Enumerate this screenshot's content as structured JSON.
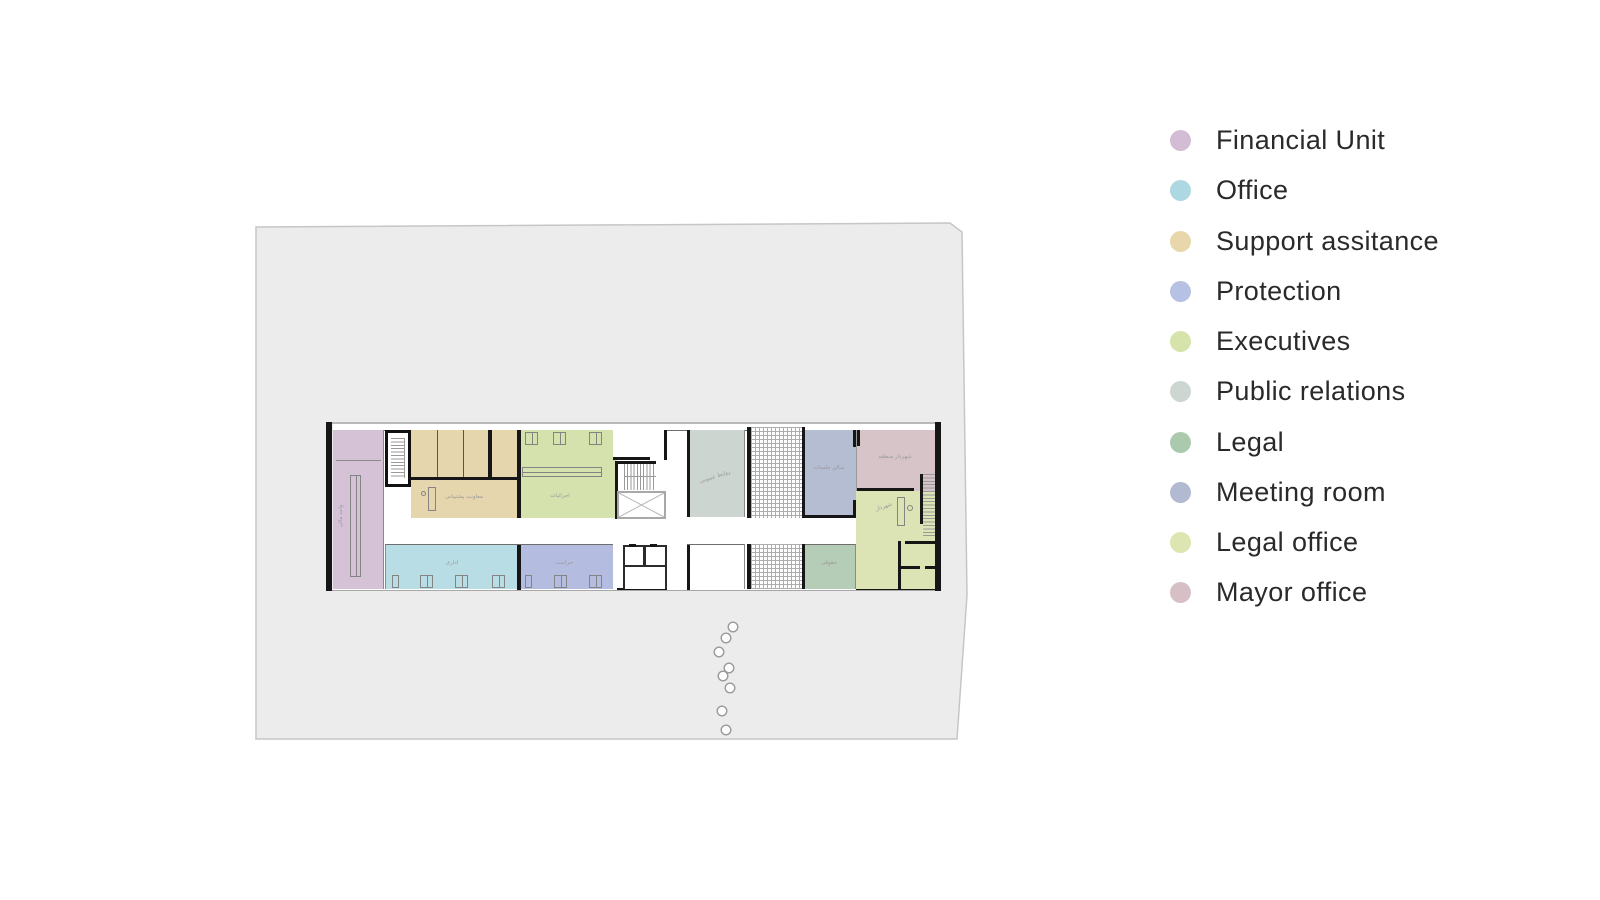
{
  "legend": {
    "items": [
      {
        "label": "Financial Unit",
        "color": "#d3bdd5"
      },
      {
        "label": "Office",
        "color": "#aed8e1"
      },
      {
        "label": "Support assitance",
        "color": "#e7d7ab"
      },
      {
        "label": "Protection",
        "color": "#b7c1e4"
      },
      {
        "label": "Executives",
        "color": "#d6e3ab"
      },
      {
        "label": "Public relations",
        "color": "#ced6d1"
      },
      {
        "label": "Legal",
        "color": "#abcaad"
      },
      {
        "label": "Meeting room",
        "color": "#b1bad1"
      },
      {
        "label": "Legal office",
        "color": "#dde5b0"
      },
      {
        "label": "Mayor office",
        "color": "#d6c0c6"
      }
    ]
  },
  "plan": {
    "site_color": "#ececec",
    "rooms": [
      {
        "id": "financial-unit",
        "label": "واحد مالی",
        "color": "#d6c2d7"
      },
      {
        "id": "support-assistance",
        "label": "معاونت پشتیبانی",
        "color": "#e6d6ad"
      },
      {
        "id": "executives",
        "label": "اجرائیات",
        "color": "#d6e2ae"
      },
      {
        "id": "public-relations",
        "label": "روابط عمومی",
        "color": "#cdd5d0"
      },
      {
        "id": "meeting-room",
        "label": "سالن جلسات",
        "color": "#b5bdd3"
      },
      {
        "id": "mayor-office",
        "label": "شهردار منطقه",
        "color": "#d7c4c9"
      },
      {
        "id": "mayor-room",
        "label": "شهردار",
        "color": "#dce4b5"
      },
      {
        "id": "office",
        "label": "اداری",
        "color": "#b9dde4"
      },
      {
        "id": "protection",
        "label": "حراست",
        "color": "#b4bcdf"
      },
      {
        "id": "legal",
        "label": "حقوقی",
        "color": "#b5ccb6"
      }
    ]
  }
}
